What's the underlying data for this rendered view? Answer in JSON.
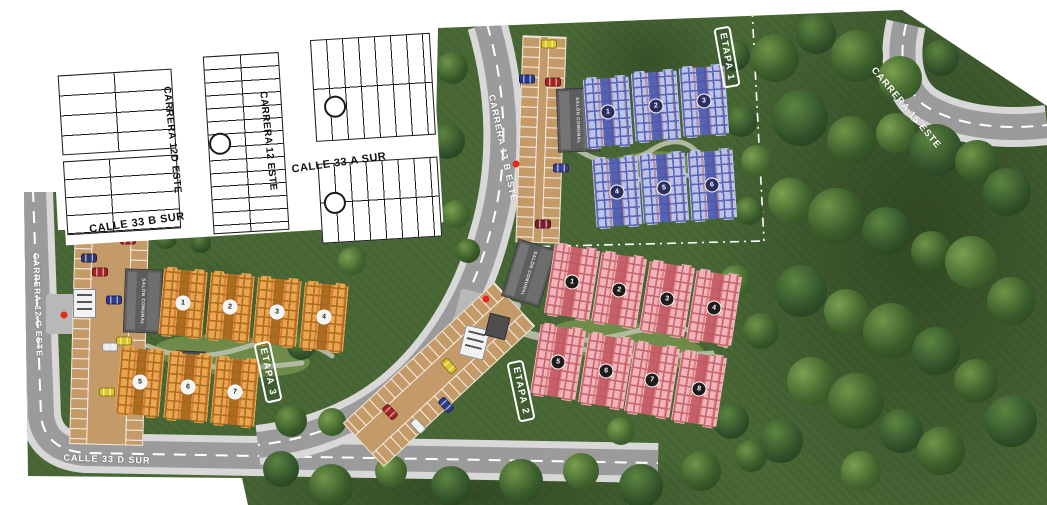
{
  "map": {
    "streets": {
      "c12d": "CARRERA 12D ESTE",
      "c12": "CARRERA 12 ESTE",
      "c33a": "CALLE 33 A SUR",
      "c33b": "CALLE 33 B SUR",
      "c12c": "CARRERA 12 C ESTE",
      "c13b": "CARRERA 13 B ESTE",
      "c15": "CARRERA 15 ESTE",
      "c33d": "CALLE 33 D SUR"
    },
    "stages": [
      {
        "label": "ETAPA 1",
        "building_color": "#b9c3ec",
        "accent": "#4a58a8",
        "badge_bg": "#2a3160",
        "badge_fg": "#ffffff",
        "blocks": 6
      },
      {
        "label": "ETAPA 2",
        "building_color": "#f1b3b9",
        "accent": "#c05862",
        "badge_bg": "#201c1c",
        "badge_fg": "#ffffff",
        "blocks": 8
      },
      {
        "label": "ETAPA 3",
        "building_color": "#e9a64f",
        "accent": "#a5661c",
        "badge_bg": "#f5f5f5",
        "badge_fg": "#222222",
        "blocks": 7
      }
    ],
    "facility_label": "SALÓN COMUNAL",
    "markers": {
      "entrance_color": "#e02a20"
    },
    "palette": {
      "grass": "#4a6836",
      "road": "#9b9b9b",
      "sidewalk": "#d8d8d8",
      "parking": "#c49a68",
      "lot_lines": "#1a1a1a"
    }
  }
}
